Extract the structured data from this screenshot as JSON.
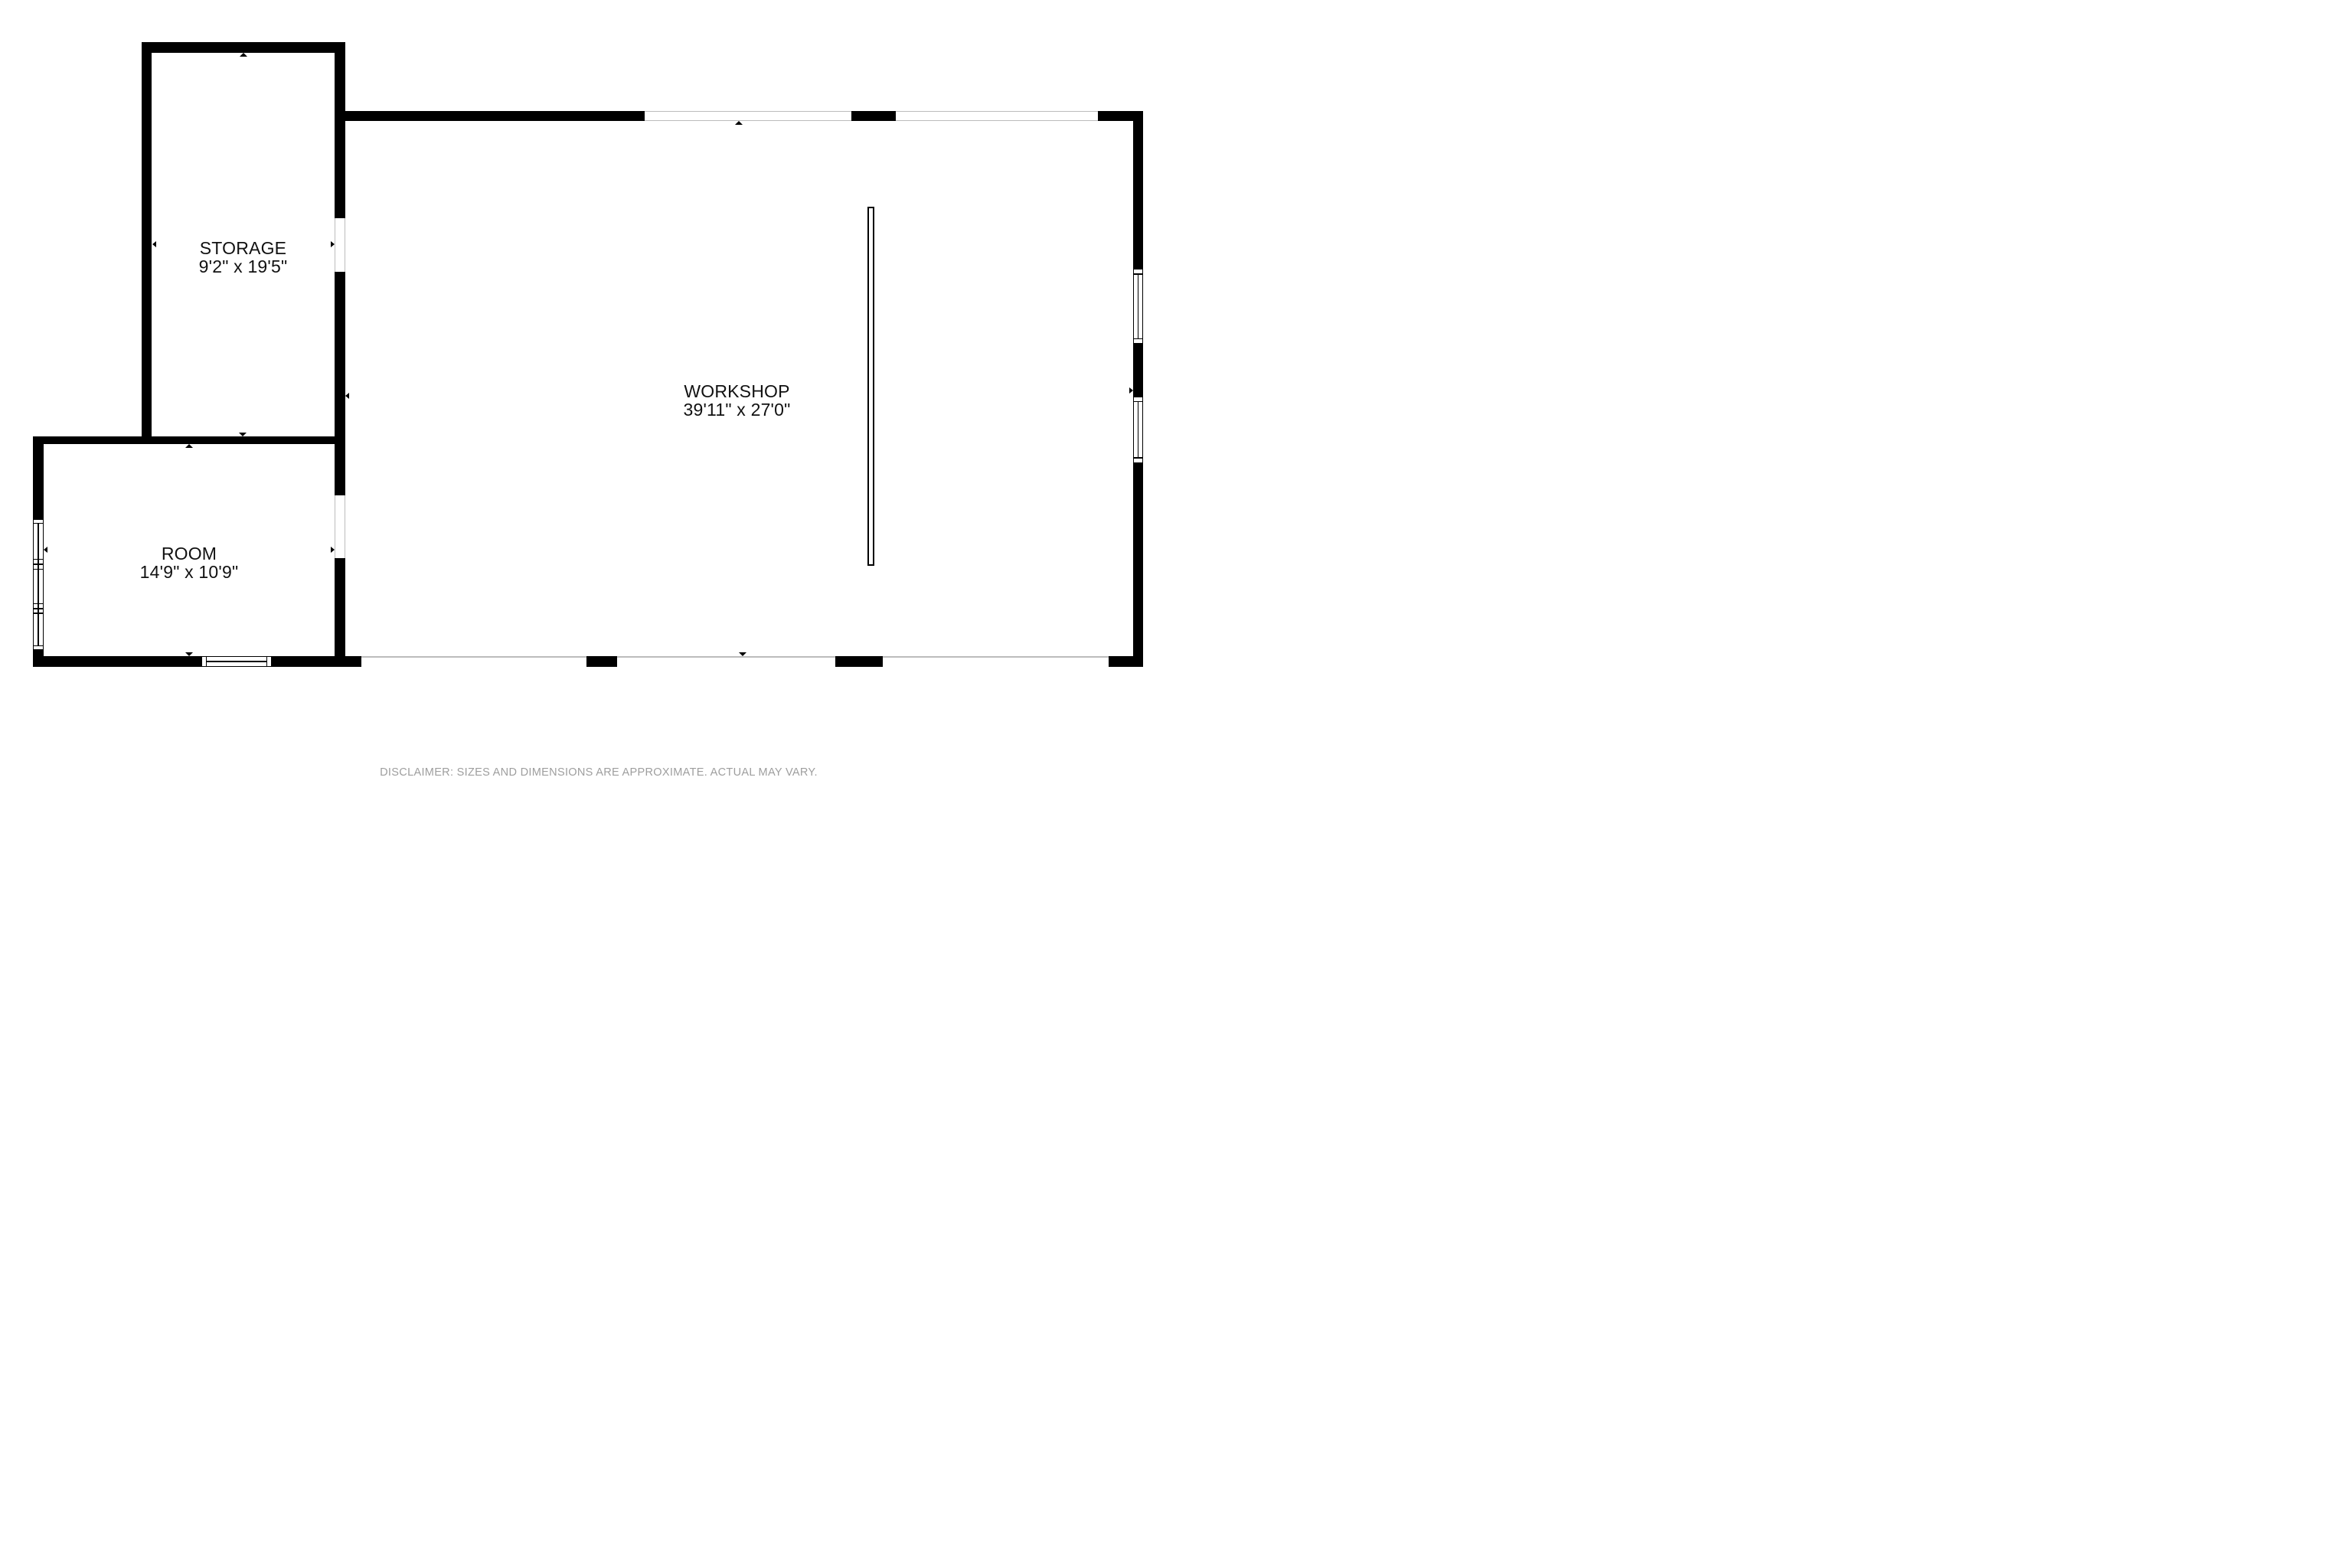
{
  "rooms": [
    {
      "name": "STORAGE",
      "dimensions": "9'2\" x 19'5\""
    },
    {
      "name": "WORKSHOP",
      "dimensions": "39'11\" x 27'0\""
    },
    {
      "name": "ROOM",
      "dimensions": "14'9\" x 10'9\""
    }
  ],
  "disclaimer": "DISCLAIMER: SIZES AND DIMENSIONS ARE APPROXIMATE. ACTUAL MAY VARY.",
  "colors": {
    "wall": "#000000",
    "background": "#ffffff",
    "opening_line": "#bcbcbc",
    "disclaimer_text": "#9e9e9e"
  }
}
